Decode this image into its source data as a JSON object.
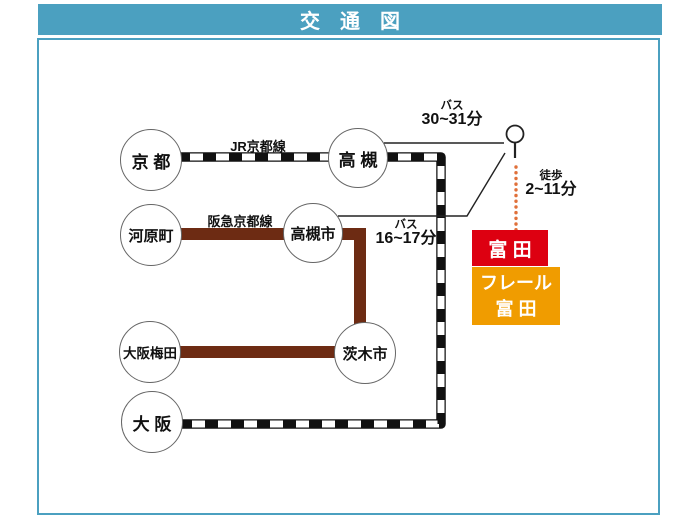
{
  "title": "交　通　図",
  "colors": {
    "header_teal": "#4ba0c0",
    "jr_line_black": "#111111",
    "hankyu_brown": "#6d2b13",
    "tomita_red": "#dd0011",
    "frail_orange": "#f09c00",
    "walk_dot_orange": "#e0703a"
  },
  "stations": [
    {
      "label": "京 都"
    },
    {
      "label": "高 槻"
    },
    {
      "label": "河原町"
    },
    {
      "label": "高槻市"
    },
    {
      "label": "大阪梅田"
    },
    {
      "label": "茨木市"
    },
    {
      "label": "大 阪"
    }
  ],
  "rail_lines": [
    {
      "name": "JR京都線"
    },
    {
      "name": "阪急京都線"
    }
  ],
  "routes": {
    "bus_from_takatsuki": {
      "mode": "バス",
      "duration": "30~31分"
    },
    "bus_from_takatsukishi": {
      "mode": "バス",
      "duration": "16~17分"
    },
    "walk": {
      "mode": "徒歩",
      "duration": "2~11分"
    }
  },
  "destination": {
    "bus_stop_name": "富 田",
    "property_line1": "フレール",
    "property_line2": "富 田"
  },
  "icons": {
    "bus_stop": "bus-stop-sign"
  }
}
